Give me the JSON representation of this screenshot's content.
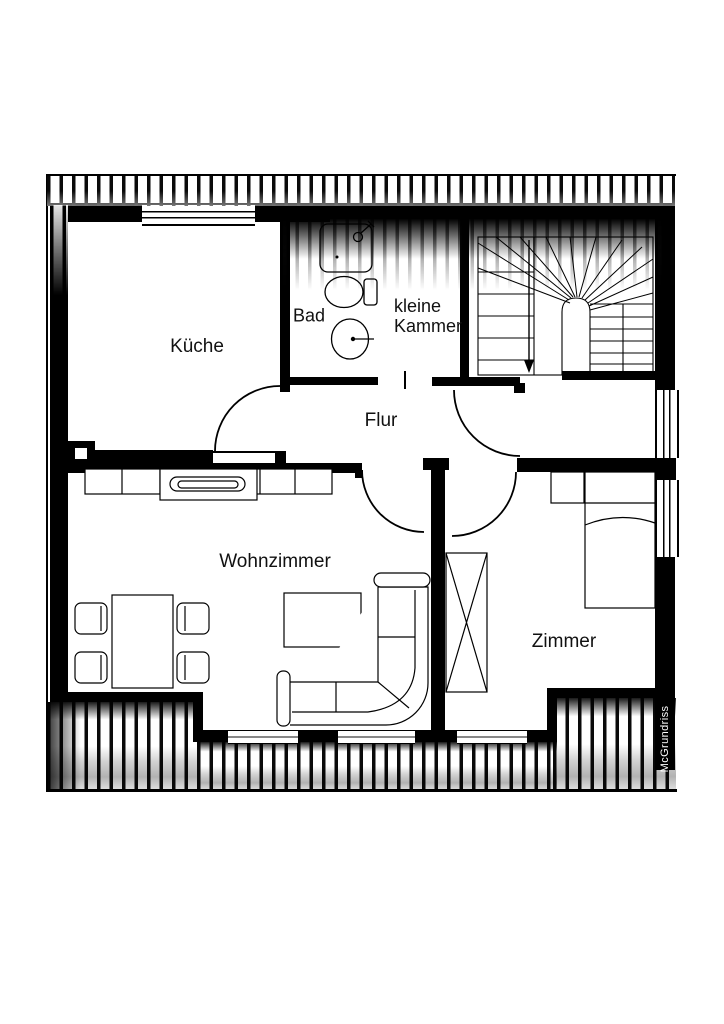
{
  "watermark": "McGrundriss",
  "rooms": {
    "kueche": {
      "label": "Küche",
      "furniture": []
    },
    "bad": {
      "label": "Bad",
      "furniture": [
        "shower",
        "toilet",
        "sink"
      ]
    },
    "kleine_kammer": {
      "label_line1": "kleine",
      "label_line2": "Kammer",
      "furniture": []
    },
    "flur": {
      "label": "Flur",
      "furniture": []
    },
    "stairwell": {
      "label": "",
      "furniture": [
        "winder-staircase",
        "stair-down-arrow"
      ]
    },
    "wohnzimmer": {
      "label": "Wohnzimmer",
      "furniture": [
        "sideboard",
        "tv-lowboard",
        "dining-table",
        "four-chairs",
        "coffee-table",
        "corner-sofa"
      ]
    },
    "zimmer": {
      "label": "Zimmer",
      "furniture": [
        "bed",
        "nightstand",
        "wardrobe"
      ]
    }
  },
  "openings": {
    "windows_top_wall": 1,
    "windows_bottom_wall": 3,
    "windows_right_wall": 2,
    "doors": [
      "kueche-door",
      "stair-door",
      "wohnzimmer-door",
      "zimmer-door",
      "kammer-opening"
    ]
  },
  "colors": {
    "wall": "#000000",
    "background": "#ffffff",
    "watermark_text": "#ffffff",
    "watermark_bg": "#000000",
    "label_text": "#111111"
  }
}
